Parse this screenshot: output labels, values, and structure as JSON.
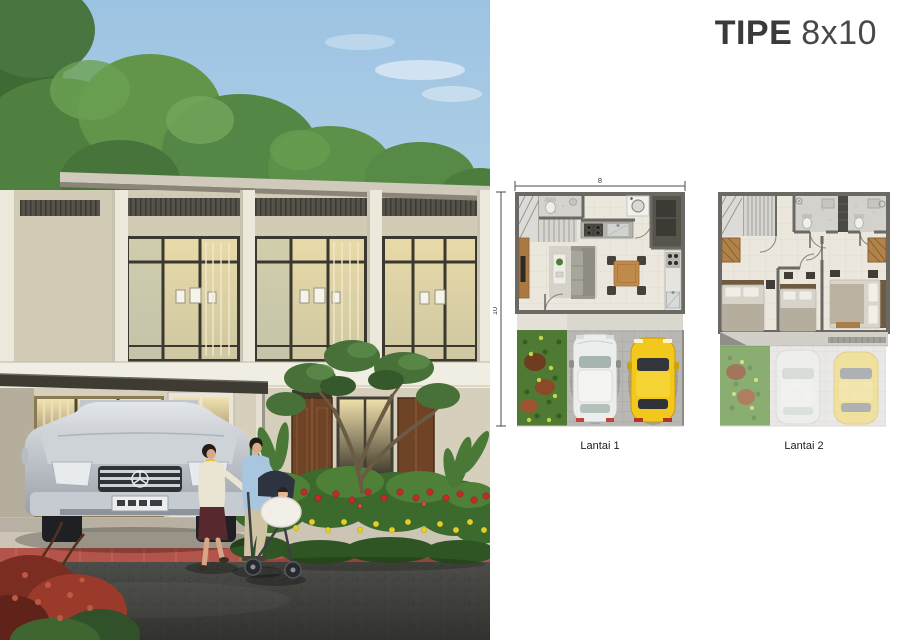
{
  "title": {
    "bold": "TIPE",
    "light": "8x10"
  },
  "floor_plans": {
    "lantai1": {
      "label": "Lantai 1",
      "dim_width": "8",
      "dim_height": "10"
    },
    "lantai2": {
      "label": "Lantai 2"
    }
  },
  "colors": {
    "title_text": "#3b3a3a",
    "background": "#ffffff",
    "plan_wall": "#6b6963",
    "plan_floor": "#ebe7dc",
    "garden_green": "#4e7a33",
    "car_yellow": "#f2c81c",
    "car_white": "#eceded",
    "sky_blue": "#9cc3e2"
  }
}
